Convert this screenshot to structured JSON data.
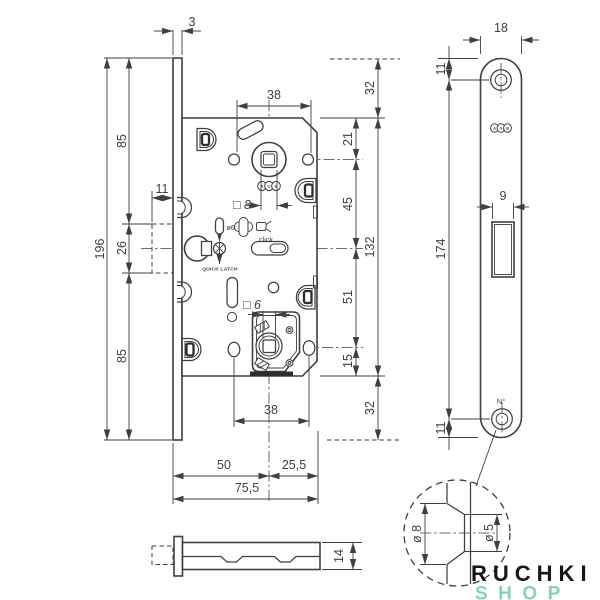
{
  "drawing": {
    "front_view": {
      "dims": {
        "plate_thickness": "3",
        "plate_height": "196",
        "top_to_latch": "85",
        "latch_zone": "26",
        "latch_to_bottom": "85",
        "latch_throw": "11",
        "handle_holes_span": "38",
        "plate_top_overhang": "32",
        "case_top_to_hub": "21",
        "hub_to_latch": "45",
        "case_height": "132",
        "latch_to_wc_hub": "51",
        "wc_hub_to_case_bottom": "15",
        "wc_holes_span": "38",
        "plate_bottom_overhang": "32",
        "backset": "50",
        "case_rear": "25,5",
        "total_depth": "75,5",
        "handle_square": "□ 8",
        "wc_square": "□ 6",
        "pin_dia": "ø6"
      },
      "labels": {
        "quick_latch": "QUICK LATCH",
        "click": "click"
      },
      "logo_letters": [
        "A",
        "G",
        "B"
      ]
    },
    "side_view": {
      "dims": {
        "case_thickness": "14"
      }
    },
    "faceplate_view": {
      "dims": {
        "width": "18",
        "top_hole_offset": "11",
        "latch_opening_width": "9",
        "holes_span": "174",
        "bottom_hole_offset": "11"
      },
      "labels": {
        "serial": "N°"
      }
    },
    "detail_view": {
      "dims": {
        "countersink_dia": "ø 8",
        "hole_dia": "ø 5"
      }
    },
    "watermark": {
      "line1": "RUCHKI",
      "line2": "SHOP"
    },
    "colors": {
      "line": "#3f3f3f",
      "mint": "#8bcfbe",
      "ink": "#161616"
    }
  }
}
